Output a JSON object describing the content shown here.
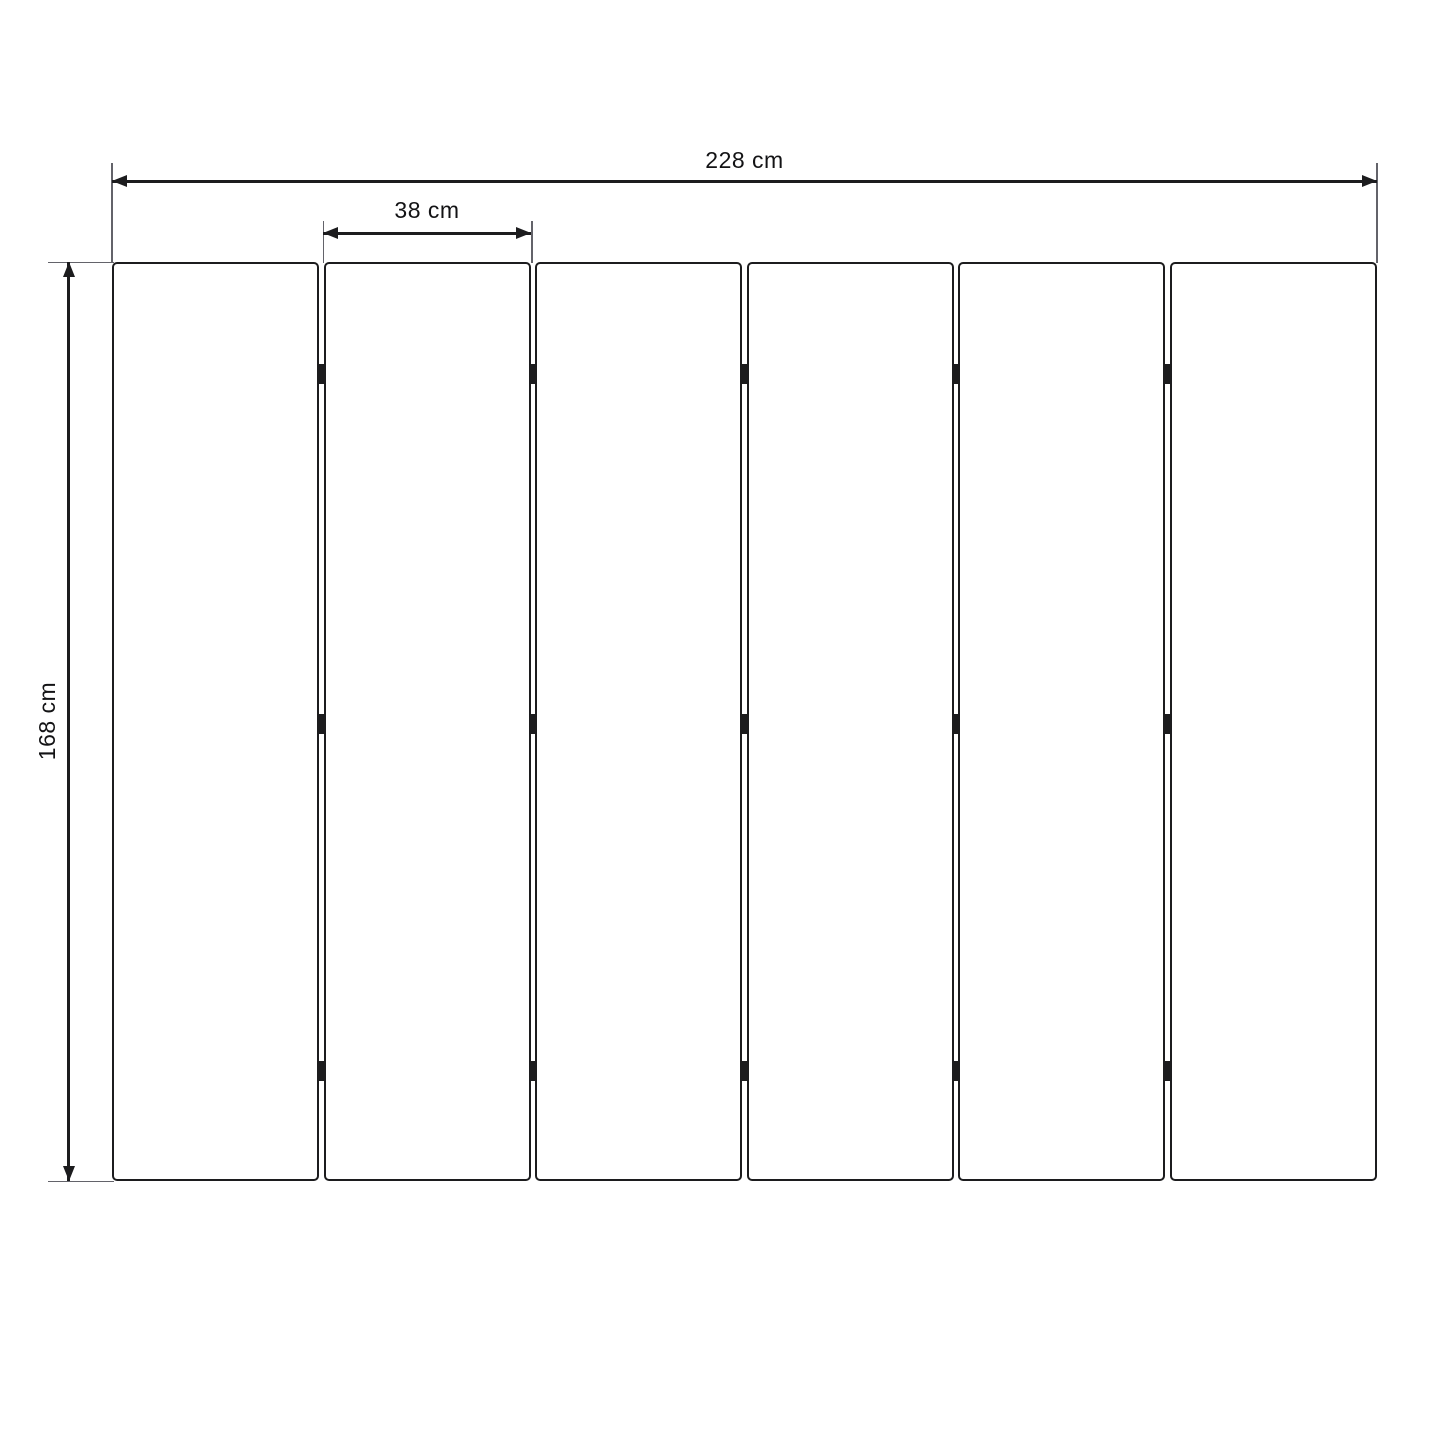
{
  "diagram": {
    "name": "folding-screen-dimension-drawing",
    "unit": "cm",
    "dimensions": {
      "total_width": {
        "label": "228 cm",
        "value": 228
      },
      "panel_width": {
        "label": "38 cm",
        "value": 38
      },
      "height": {
        "label": "168 cm",
        "value": 168
      }
    },
    "panels": {
      "count": 6,
      "hinge_columns": 5,
      "hinge_rows": 3
    },
    "colors": {
      "background": "#ffffff",
      "line": "#1c1c1e",
      "extension_line": "#63636a",
      "label": "#131315"
    }
  }
}
